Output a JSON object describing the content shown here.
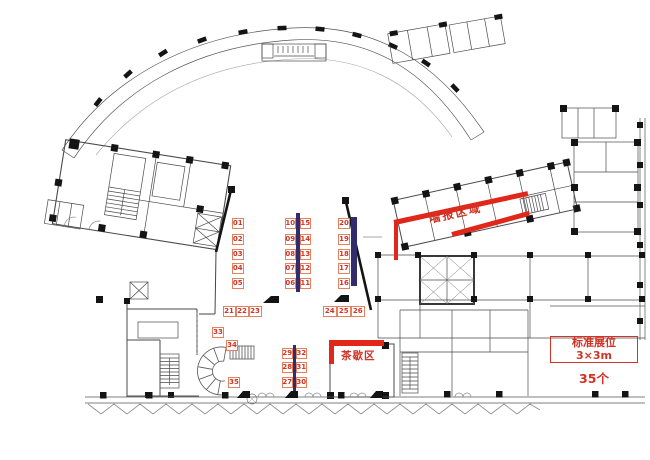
{
  "plan": {
    "annotations": {
      "poster_area_label": "墙报区域",
      "tea_break_label": "茶歇区",
      "legend": {
        "line1": "标准展位",
        "line2": "3×3m",
        "count": "35个"
      }
    },
    "colors": {
      "annotation_red": "#e1261a",
      "label_red": "#d23325",
      "booth_border": "#e4815e",
      "booth_number": "#d23325",
      "bar_indigo": "#322c6e"
    },
    "booths": [
      {
        "n": "01",
        "x": 232,
        "y": 217.5,
        "w": 11.5,
        "h": 11
      },
      {
        "n": "02",
        "x": 232,
        "y": 233.5,
        "w": 11.5,
        "h": 11
      },
      {
        "n": "03",
        "x": 232,
        "y": 248.5,
        "w": 11.5,
        "h": 11
      },
      {
        "n": "04",
        "x": 232,
        "y": 263,
        "w": 11.5,
        "h": 11
      },
      {
        "n": "05",
        "x": 232,
        "y": 277.5,
        "w": 11.5,
        "h": 11
      },
      {
        "n": "06",
        "x": 284.5,
        "y": 277.5,
        "w": 11.5,
        "h": 11
      },
      {
        "n": "07",
        "x": 284.5,
        "y": 263,
        "w": 11.5,
        "h": 11
      },
      {
        "n": "08",
        "x": 284.5,
        "y": 248.5,
        "w": 11.5,
        "h": 11
      },
      {
        "n": "09",
        "x": 284.5,
        "y": 233.5,
        "w": 11.5,
        "h": 11
      },
      {
        "n": "10",
        "x": 284.5,
        "y": 217.5,
        "w": 11.5,
        "h": 11
      },
      {
        "n": "11",
        "x": 299.5,
        "y": 277.5,
        "w": 11.5,
        "h": 11
      },
      {
        "n": "12",
        "x": 299.5,
        "y": 263,
        "w": 11.5,
        "h": 11
      },
      {
        "n": "13",
        "x": 299.5,
        "y": 248.5,
        "w": 11.5,
        "h": 11
      },
      {
        "n": "14",
        "x": 299.5,
        "y": 233.5,
        "w": 11.5,
        "h": 11
      },
      {
        "n": "15",
        "x": 299.5,
        "y": 217.5,
        "w": 11.5,
        "h": 11
      },
      {
        "n": "16",
        "x": 338,
        "y": 277.5,
        "w": 12,
        "h": 11
      },
      {
        "n": "17",
        "x": 338,
        "y": 263,
        "w": 12,
        "h": 11
      },
      {
        "n": "18",
        "x": 338,
        "y": 248.5,
        "w": 12,
        "h": 11
      },
      {
        "n": "19",
        "x": 338,
        "y": 233.5,
        "w": 12,
        "h": 11
      },
      {
        "n": "20",
        "x": 338,
        "y": 217.5,
        "w": 12,
        "h": 11
      },
      {
        "n": "21",
        "x": 222.5,
        "y": 306,
        "w": 13,
        "h": 11
      },
      {
        "n": "22",
        "x": 235.5,
        "y": 306,
        "w": 13,
        "h": 11
      },
      {
        "n": "23",
        "x": 248.5,
        "y": 306,
        "w": 13,
        "h": 11
      },
      {
        "n": "24",
        "x": 323,
        "y": 306,
        "w": 13.5,
        "h": 11
      },
      {
        "n": "25",
        "x": 337,
        "y": 306,
        "w": 13.5,
        "h": 11
      },
      {
        "n": "26",
        "x": 351,
        "y": 306,
        "w": 13.5,
        "h": 11
      },
      {
        "n": "27",
        "x": 281.5,
        "y": 376.5,
        "w": 11.5,
        "h": 11
      },
      {
        "n": "28",
        "x": 281.5,
        "y": 362,
        "w": 11.5,
        "h": 11
      },
      {
        "n": "29",
        "x": 281.5,
        "y": 347.5,
        "w": 11.5,
        "h": 11
      },
      {
        "n": "30",
        "x": 295.8,
        "y": 376.5,
        "w": 11,
        "h": 11
      },
      {
        "n": "31",
        "x": 295.8,
        "y": 362,
        "w": 11,
        "h": 11
      },
      {
        "n": "32",
        "x": 295.8,
        "y": 347.5,
        "w": 11,
        "h": 11
      },
      {
        "n": "33",
        "x": 212,
        "y": 327,
        "w": 12,
        "h": 11
      },
      {
        "n": "34",
        "x": 226,
        "y": 340,
        "w": 12,
        "h": 11
      },
      {
        "n": "35",
        "x": 228,
        "y": 376.5,
        "w": 12,
        "h": 11
      }
    ],
    "bars": [
      {
        "x": 296,
        "y": 212.5,
        "w": 3.5,
        "h": 79.5
      },
      {
        "x": 351,
        "y": 217,
        "w": 5.5,
        "h": 69
      },
      {
        "x": 293,
        "y": 344.5,
        "w": 3,
        "h": 46
      }
    ]
  }
}
